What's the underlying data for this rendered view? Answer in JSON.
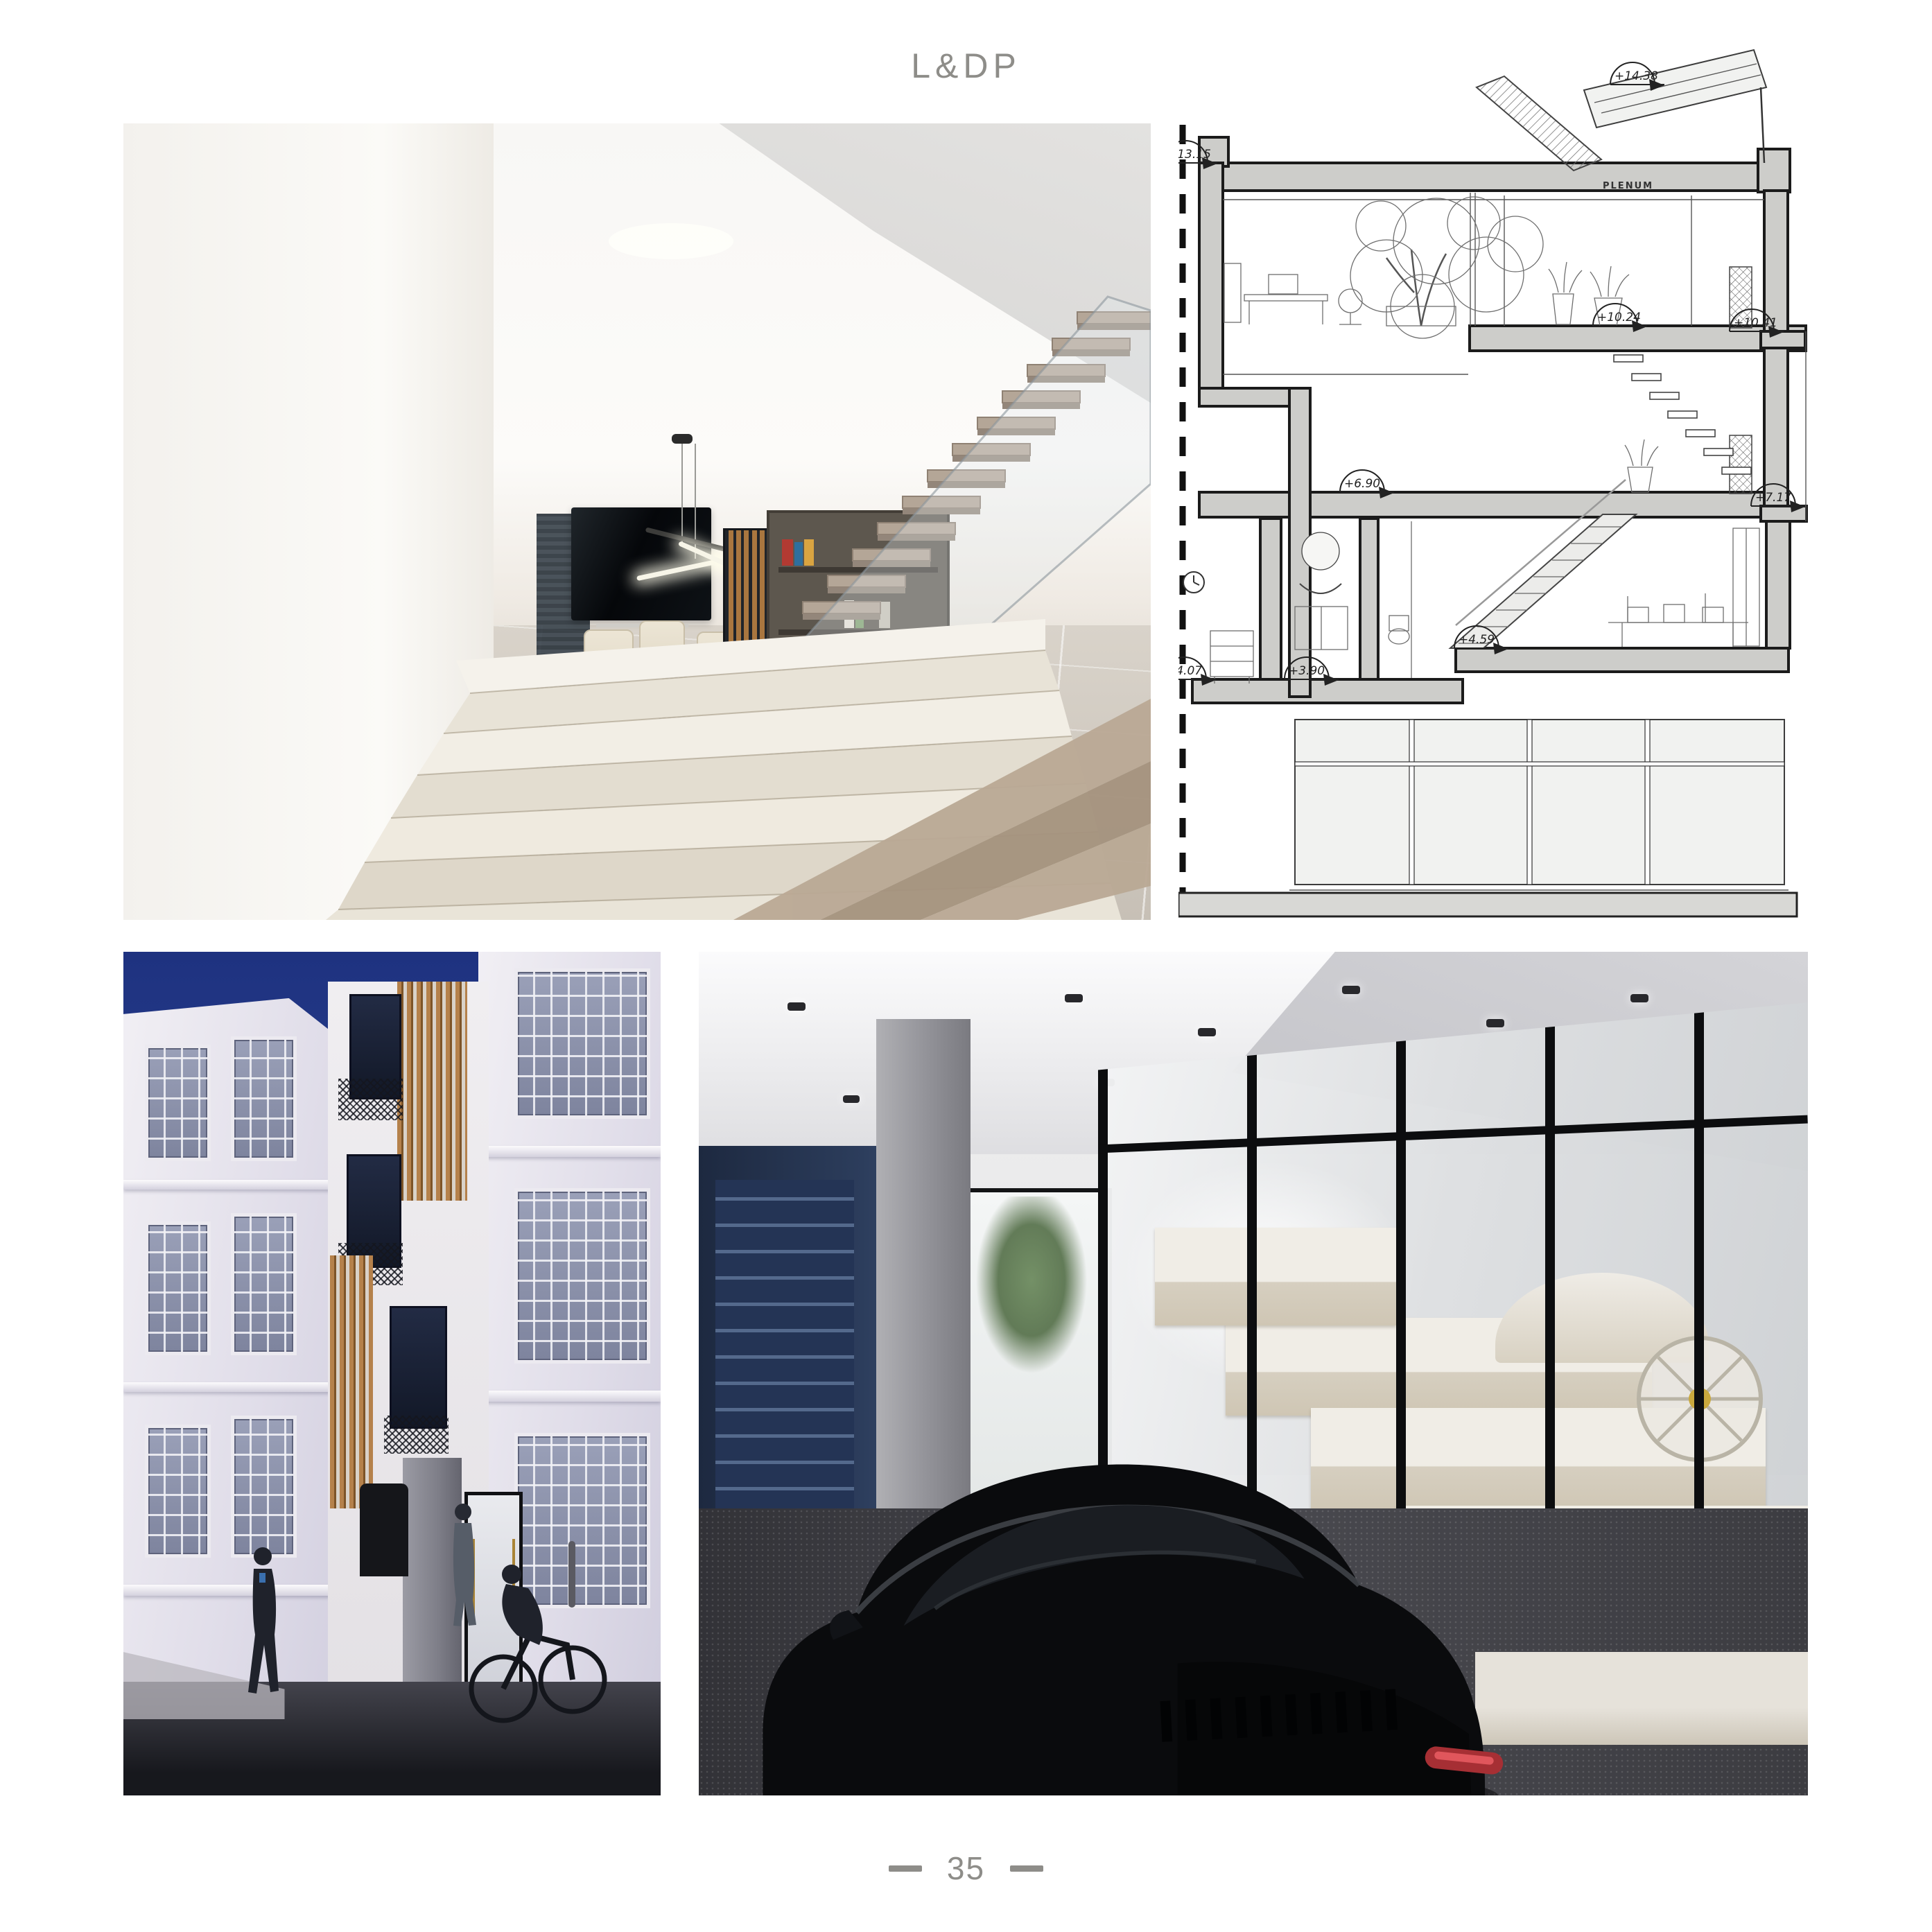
{
  "page": {
    "brand": "L&DP",
    "page_number": "35",
    "marker_dash": "—"
  },
  "section_drawing": {
    "room_label": "PLENUM",
    "level_annotations": [
      "+14.38",
      "+13.15",
      "+10.41",
      "+10.24",
      "+7.17",
      "+6.90",
      "+4.59",
      "+4.07",
      "+3.90"
    ]
  },
  "colors": {
    "muted_text": "#8e8d89",
    "drawing_ink": "#1b1b1b",
    "poche_gray": "#cdcdca",
    "sky_blue": "#2b418f",
    "timber": "#b5814b",
    "marble_ivory": "#f0ede6",
    "car_black": "#0b0c0e",
    "taillight_red": "#a62f34"
  }
}
